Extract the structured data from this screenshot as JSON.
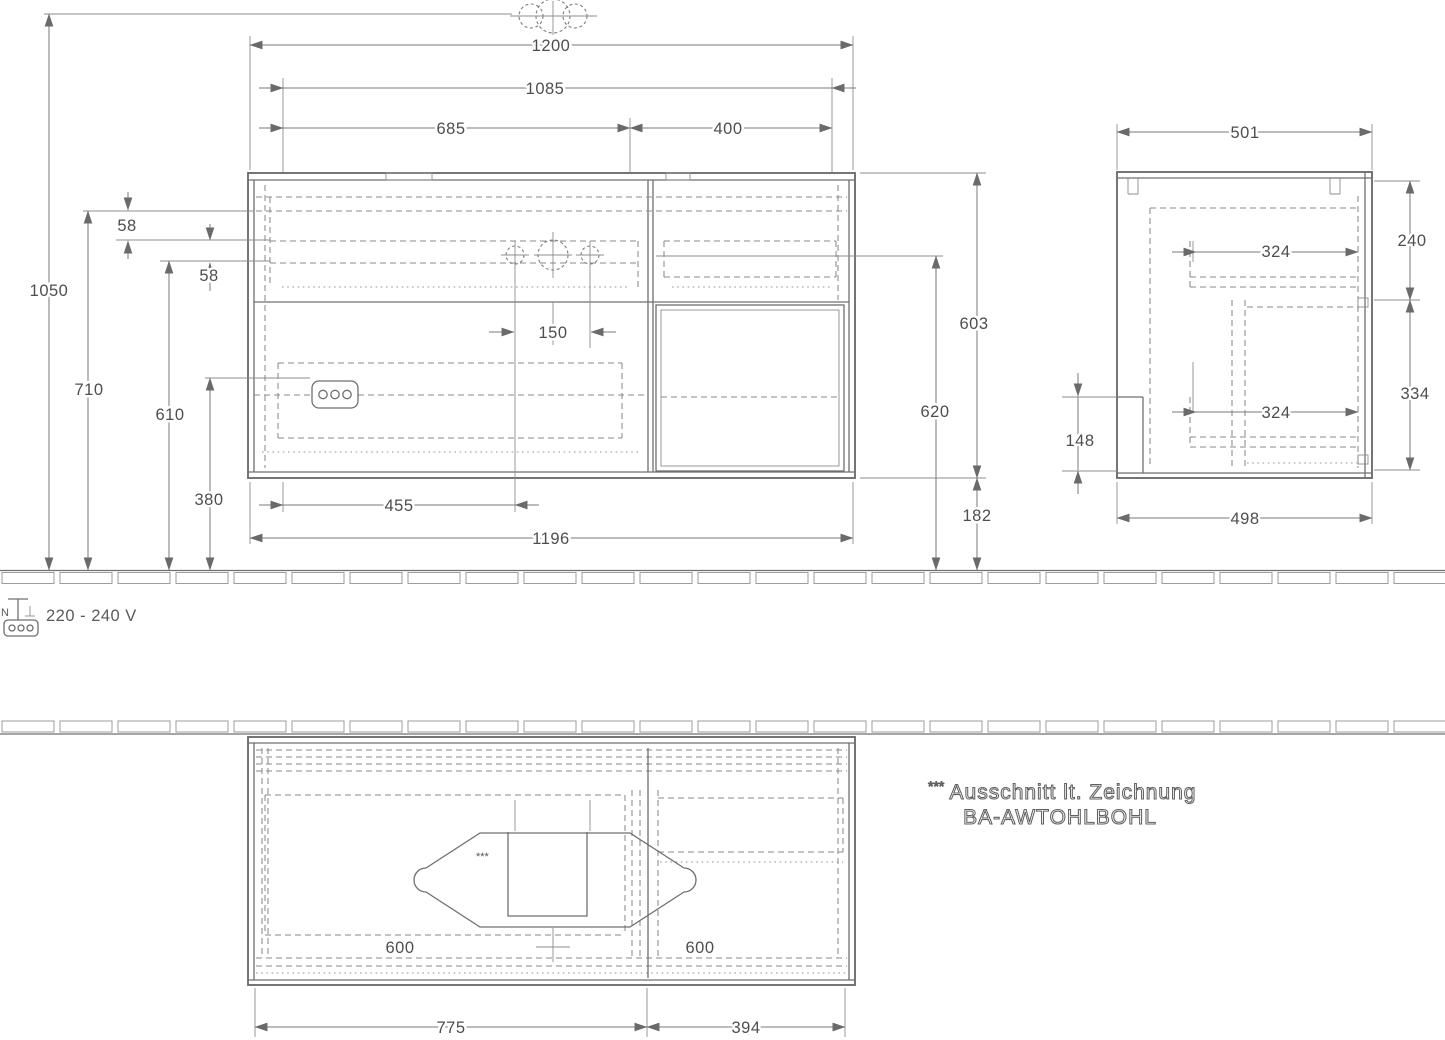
{
  "views": {
    "front": {
      "dims": {
        "top_width": "1200",
        "inner_width": "1085",
        "left_width": "685",
        "right_width": "400",
        "faucet_spacing": "150",
        "drain_offset": "455",
        "body_width": "1196",
        "total_height": "1050",
        "mid_height": "710",
        "siphon_height": "610",
        "low_height": "380",
        "gap_a": "58",
        "gap_b": "58",
        "front_height": "603",
        "basin_height": "620",
        "bottom_clearance": "182"
      }
    },
    "side": {
      "dims": {
        "depth": "501",
        "rear_top": "240",
        "drawer_top": "324",
        "rear_bottom": "334",
        "drawer_bottom": "324",
        "recess": "148",
        "depth_bottom": "498"
      }
    },
    "plan": {
      "dims": {
        "module_left": "600",
        "module_right": "600",
        "width_left": "775",
        "width_right": "394"
      },
      "cutout_marker": "***"
    }
  },
  "electrical": {
    "voltage_label": "220 - 240 V",
    "neutral_label": "N"
  },
  "note": {
    "stars": "***",
    "line1": "Ausschnitt lt. Zeichnung",
    "line2": "BA-AWTOHLBOHL"
  }
}
